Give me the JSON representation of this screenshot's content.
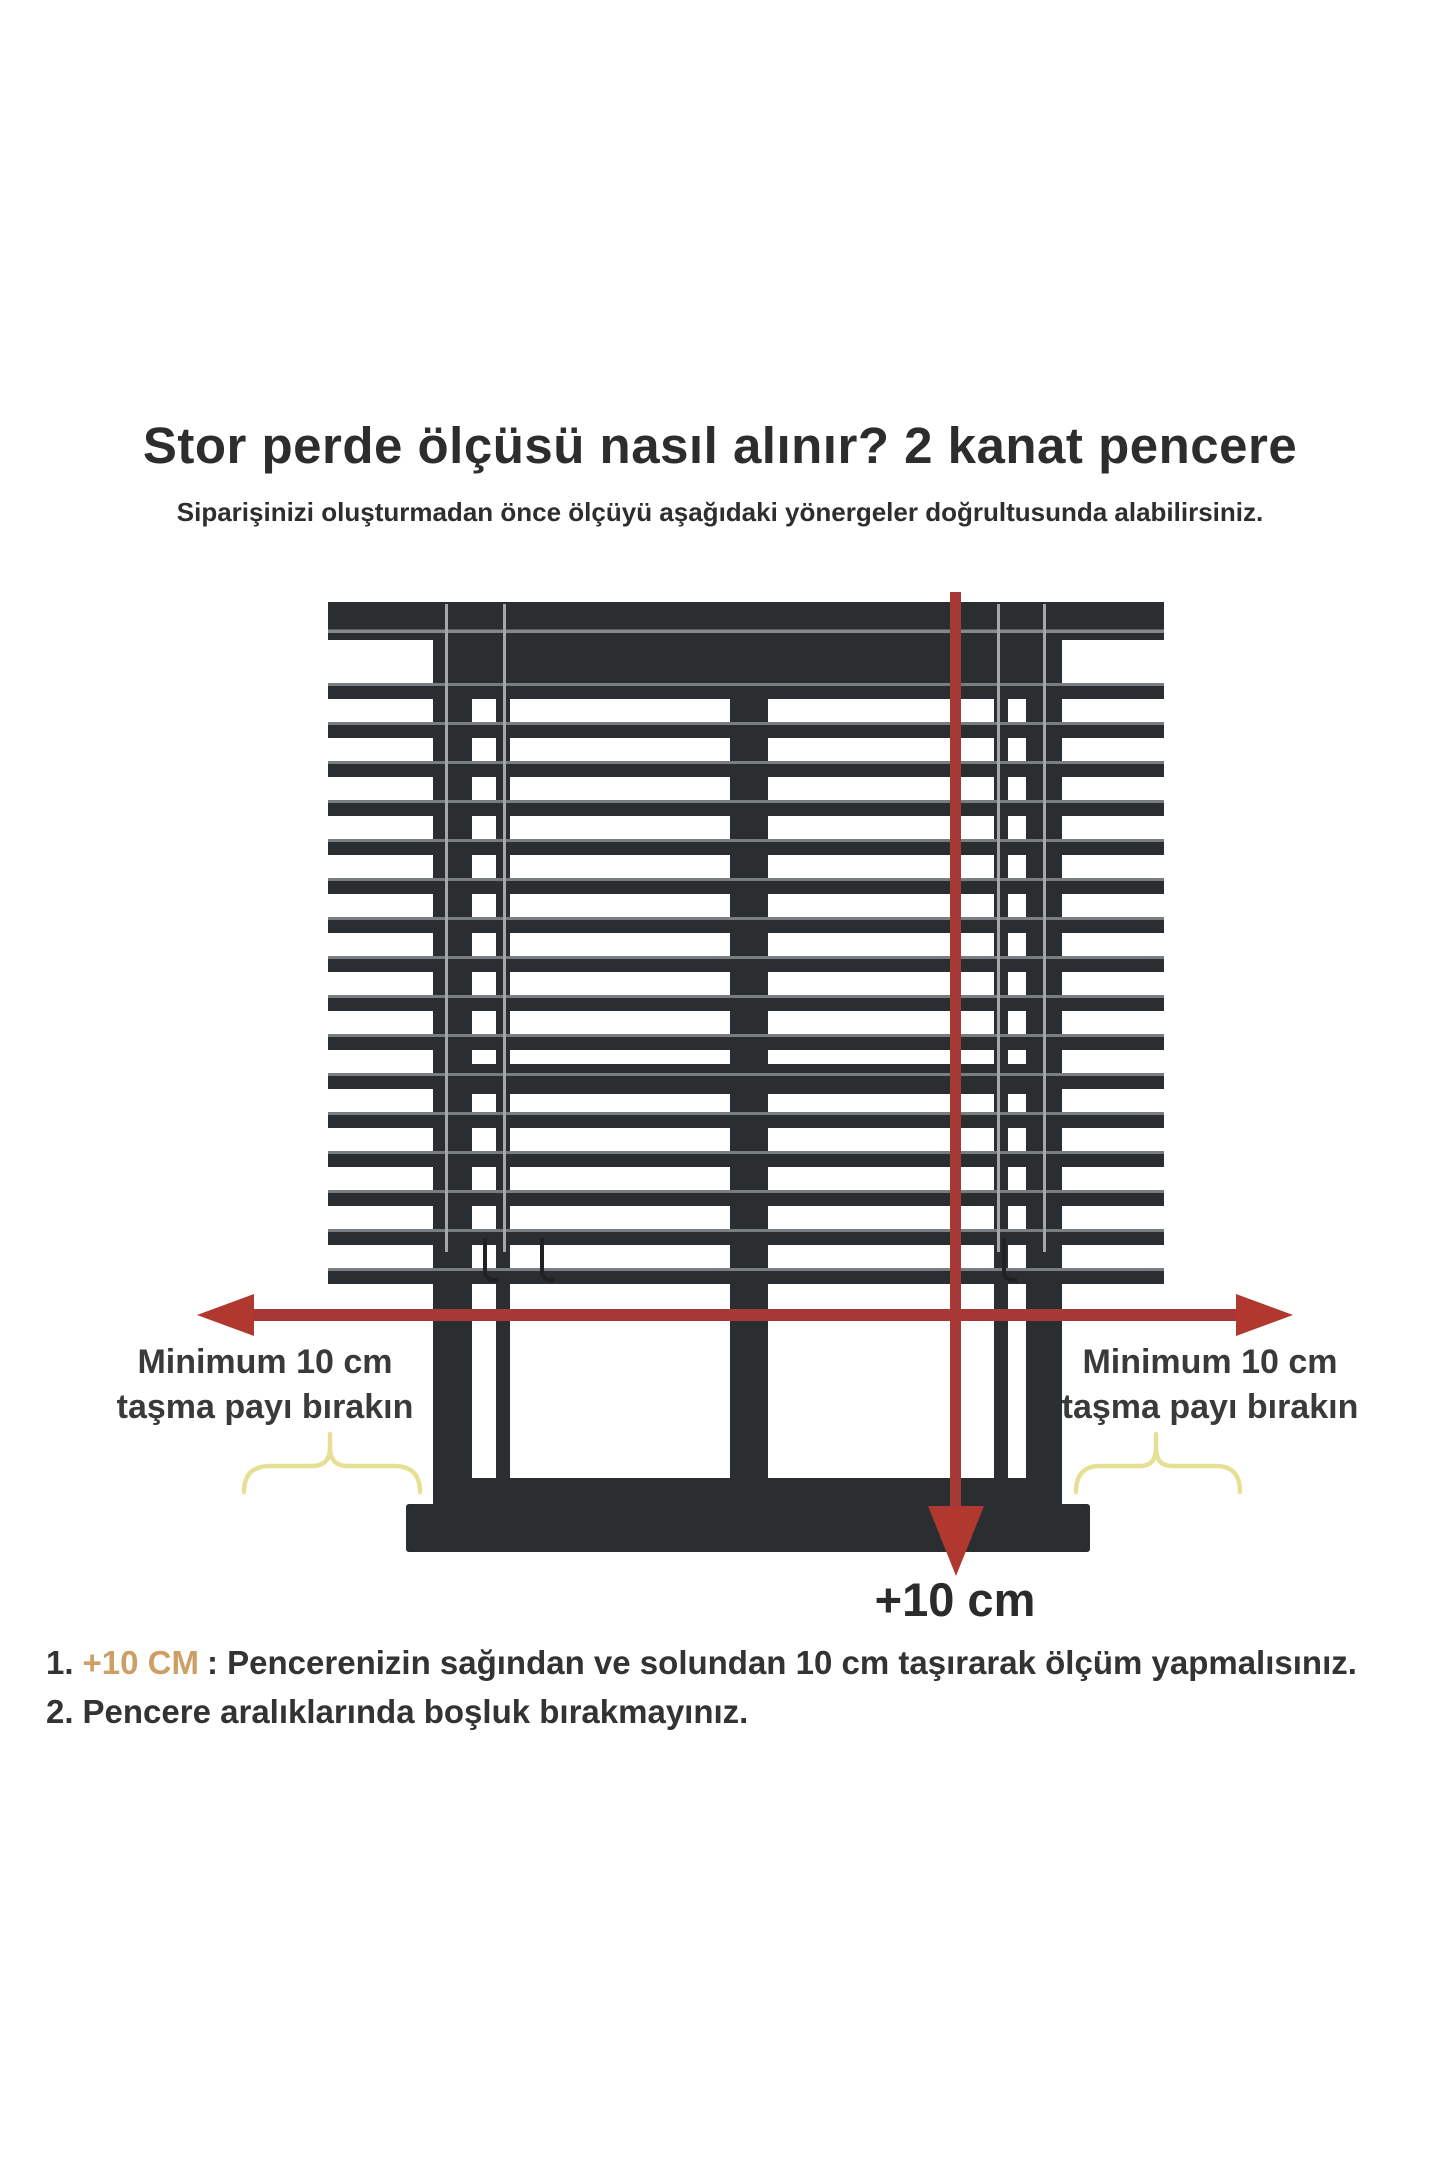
{
  "title": "Stor perde ölçüsü nasıl alınır? 2 kanat pencere",
  "subtitle": "Siparişinizi oluşturmadan önce ölçüyü aşağıdaki yönergeler doğrultusunda alabilirsiniz.",
  "diagram": {
    "left_label_line1": "Minimum 10 cm",
    "left_label_line2": "taşma payı bırakın",
    "right_label_line1": "Minimum 10 cm",
    "right_label_line2": "taşma payı bırakın",
    "plus_label": "+10 cm",
    "colors": {
      "frame_dark": "#2b2e30",
      "slat_highlight": "#797e81",
      "arrow_red": "#b0382f",
      "bracket_yellow": "#e6e095",
      "highlight_tan": "#cd9f66"
    }
  },
  "notes": [
    {
      "number": "1.",
      "highlight": "+10 CM",
      "rest": ": Pencerenizin sağından ve solundan 10 cm taşırarak ölçüm yapmalısınız."
    },
    {
      "number": "2.",
      "highlight": "",
      "rest": "Pencere aralıklarında boşluk bırakmayınız."
    }
  ]
}
